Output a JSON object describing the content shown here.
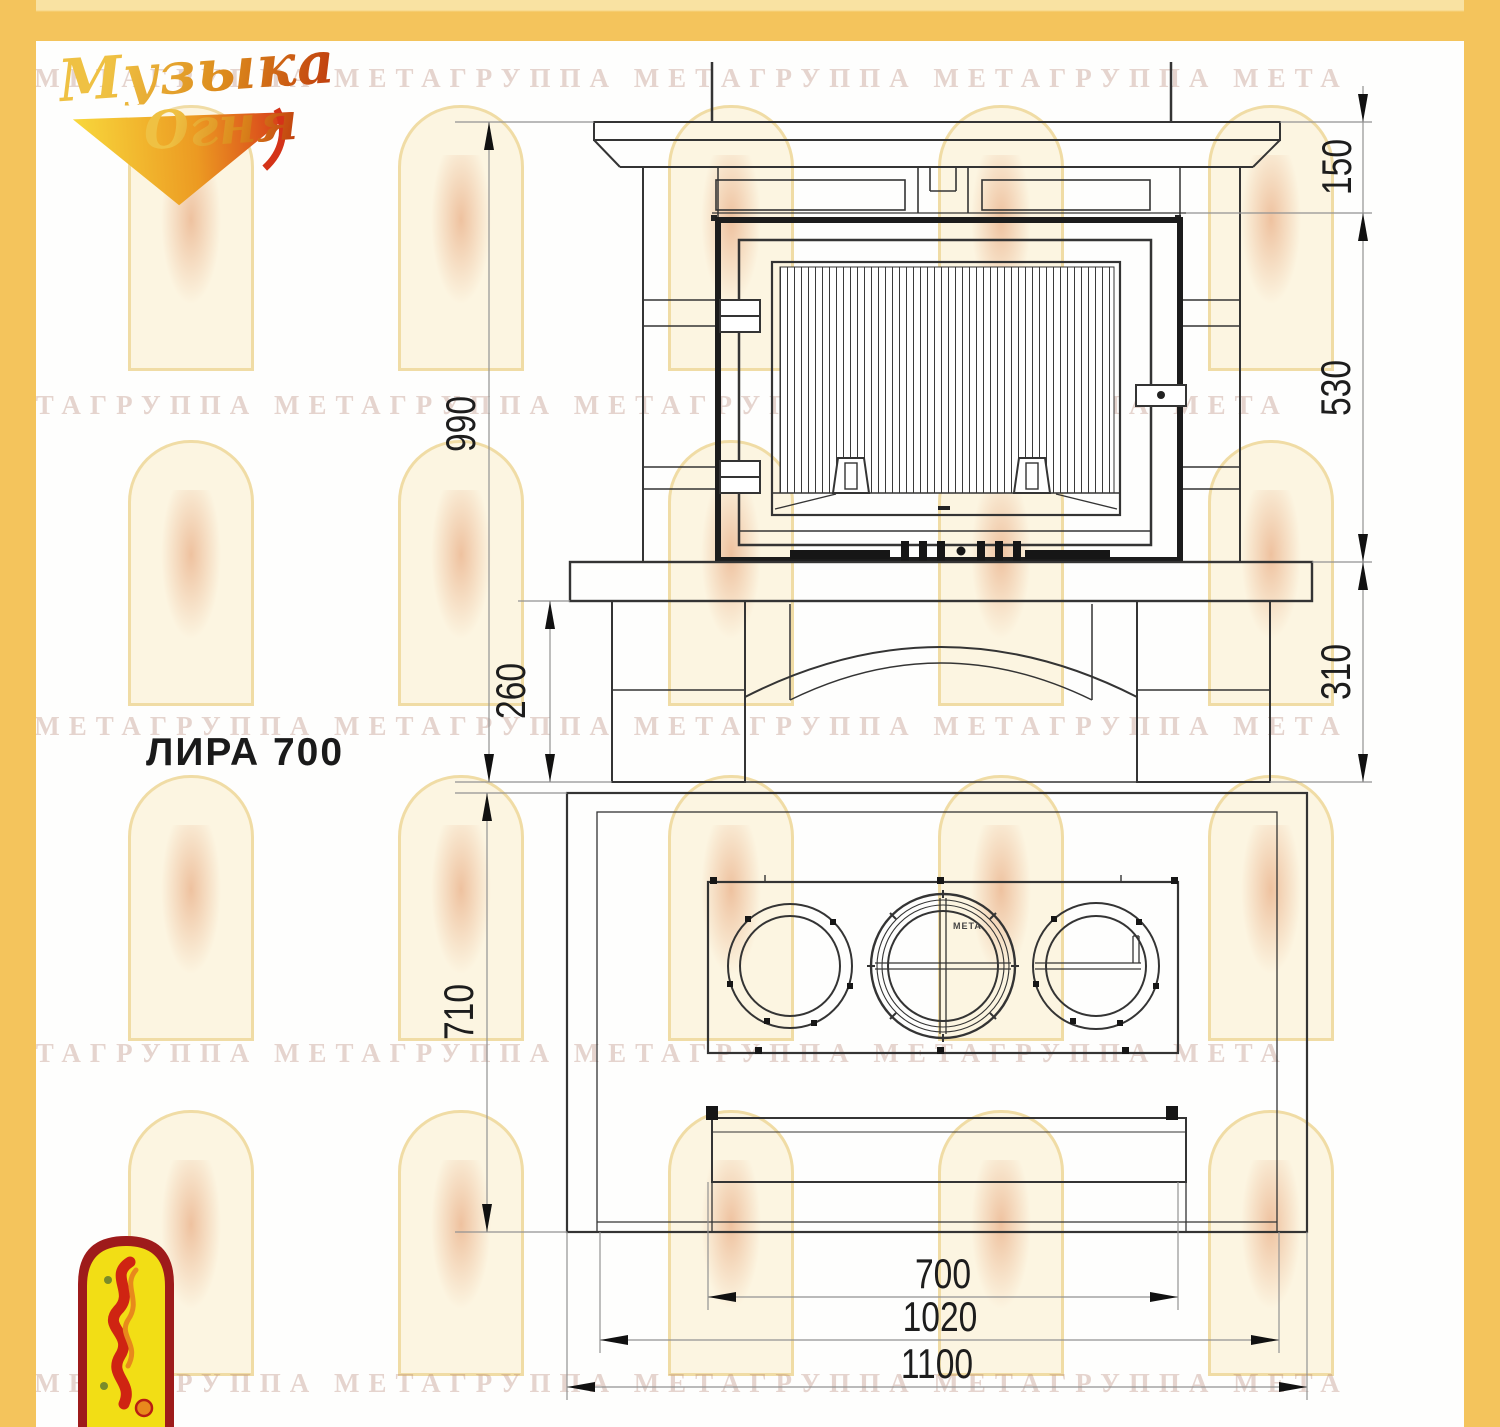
{
  "title": "ЛИРА 700",
  "logo": {
    "line1": "Музыка",
    "line2": "Огня"
  },
  "watermark_text": "ППА МЕТАГРУППА МЕТАГРУППА МЕТАГРУППА МЕТАГРУППА МЕТА",
  "front_view": {
    "dim_total_height": "990",
    "dim_base_height": "260",
    "dim_mantel_to_firebox": "150",
    "dim_firebox_height": "530",
    "dim_firebox_to_floor": "310"
  },
  "plan_view": {
    "dim_depth": "710",
    "dim_firebox_width": "700",
    "dim_inner_width": "1020",
    "dim_total_width": "1100",
    "flue_label": "МЕТА"
  },
  "colors": {
    "border_yellow": "#F4C45C",
    "line_dark": "#343434",
    "dim_gray": "#929292",
    "emblem_red": "#9E1B1B",
    "emblem_yellow": "#F2DE15",
    "logo_gold": "#EFC143",
    "logo_red": "#C2430F"
  }
}
